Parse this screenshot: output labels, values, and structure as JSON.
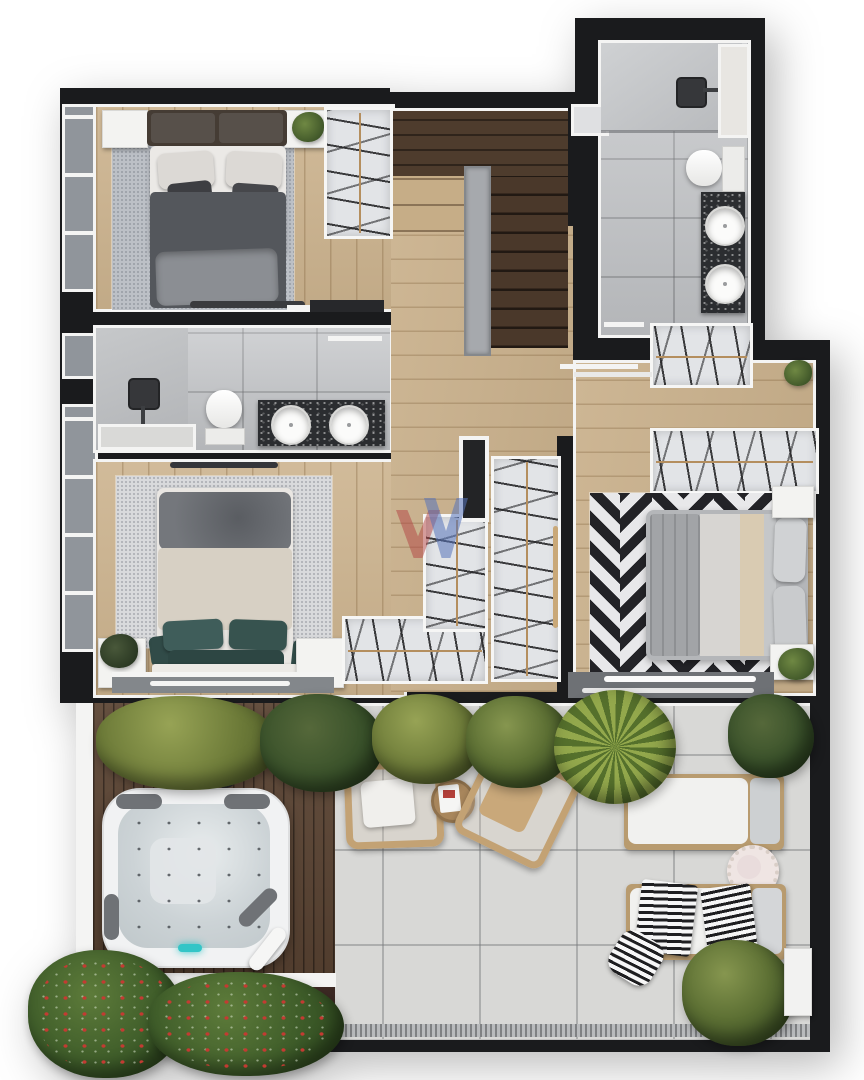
{
  "document_type": "architectural-floor-plan-top-view",
  "watermark_logo": {
    "shape": "double-chevron-w",
    "red": "#b24242",
    "blue": "#5573b9"
  },
  "floor_plan": {
    "rooms": [
      {
        "id": "bedroom-1",
        "position": "top-left",
        "items": [
          "double-bed",
          "dark-gray-duvet",
          "two-pillows",
          "speckled-area-rug",
          "nightstand-left",
          "nightstand-right",
          "potted-plant",
          "built-in-wardrobe-with-hanging-clothes",
          "foot-bench",
          "tall-window-left-wall"
        ]
      },
      {
        "id": "staircase",
        "position": "top-center",
        "items": [
          "dark-wood-upper-landing",
          "u-return-stair",
          "center-glass-railing",
          "nine-dark-treads",
          "two-light-treads"
        ]
      },
      {
        "id": "bathroom-1",
        "position": "top-right",
        "items": [
          "walk-in-shower",
          "rain-shower-head",
          "tall-window",
          "toilet",
          "black-stone-vanity",
          "round-sink",
          "round-sink",
          "wall-niche"
        ]
      },
      {
        "id": "bathroom-2",
        "position": "middle-left",
        "items": [
          "walk-in-shower",
          "rain-shower-head",
          "low-window-bench",
          "toilet",
          "black-stone-vanity",
          "round-sink",
          "round-sink",
          "open-door",
          "mirror-strip"
        ]
      },
      {
        "id": "bedroom-2",
        "position": "center-left",
        "items": [
          "double-bed",
          "beige-duvet",
          "gray-throw",
          "teal-pillows",
          "speckled-area-rug",
          "nightstand-left",
          "nightstand-right",
          "potted-plant",
          "wall-shelf",
          "built-in-wardrobe-with-hanging-clothes",
          "sliding-door-to-terrace",
          "two-windows-left-wall"
        ]
      },
      {
        "id": "walk-in-closet",
        "position": "center",
        "items": [
          "wardrobe-a-vertical",
          "wardrobe-b-vertical",
          "wardrobe-c-horizontal",
          "wood-sliding-panel-handle",
          "open-door-frame"
        ]
      },
      {
        "id": "bedroom-3-suite",
        "position": "center-right",
        "items": [
          "double-bed",
          "gray-bedding",
          "beige-runner",
          "two-pillows",
          "black-white-chevron-rug",
          "nightstand-top",
          "nightstand-bottom",
          "potted-plant",
          "entry-wardrobe-with-hanging-clothes",
          "built-in-wardrobe-with-hanging-clothes",
          "entry-pocket-door",
          "wide-sliding-door-to-terrace"
        ]
      },
      {
        "id": "terrace",
        "position": "bottom",
        "items": [
          "dark-wood-deck",
          "square-hot-tub",
          "four-headrest-pads",
          "hydro-jets",
          "teal-led-light",
          "rolled-towel",
          "round-outdoor-speaker",
          "wood-armchair-with-white-cushion",
          "wood-armchair-angled",
          "round-coffee-table-with-magazine",
          "sun-lounger-white-cushion",
          "sun-lounger-with-striped-towels",
          "fringed-round-side-table",
          "planter-hedge-row",
          "spiky-palm-plant",
          "corner-palm-plant",
          "large-floor-plant",
          "strawberry-planter-bed",
          "garden-soil-bed",
          "drain-grate-strip",
          "large-format-gray-tile"
        ]
      }
    ],
    "materials": {
      "interior_floor": "light-oak-plank",
      "stairs": "dark-walnut",
      "deck": "dark-teak",
      "terrace_floor": "light-gray-porcelain-tile",
      "walls": "dark-charcoal",
      "wall_trim": "white"
    },
    "counts": {
      "bedrooms": 3,
      "bathrooms": 2,
      "sinks": 4,
      "toilets": 2,
      "showers": 2,
      "sun_loungers": 2,
      "armchairs": 2,
      "hot_tubs": 1
    },
    "palette": {
      "background": "#ffffff",
      "wall": "#1a1b1d",
      "trim": "#f4f4f3",
      "wood_light": "#ccb38e",
      "wood_dark_stair": "#4a382a",
      "deck_wood": "#5c4534",
      "tile_gray": "#bfc1c4",
      "terrace_tile": "#d8d8d6",
      "granite_counter": "#2b2d30",
      "rug_gray": "#bcc0c6",
      "duvet_dark": "#54575c",
      "duvet_beige": "#d7d0c4",
      "pillow_teal": "#3f5d5a",
      "chevron_black": "#232327",
      "hot_tub_shell": "#f1f2f3",
      "hot_tub_water": "#ccd3d6",
      "led_teal": "#33c5c7",
      "plant_green": "#5d7034",
      "berry_red": "#c33b32",
      "chair_wood": "#c3a274"
    }
  }
}
